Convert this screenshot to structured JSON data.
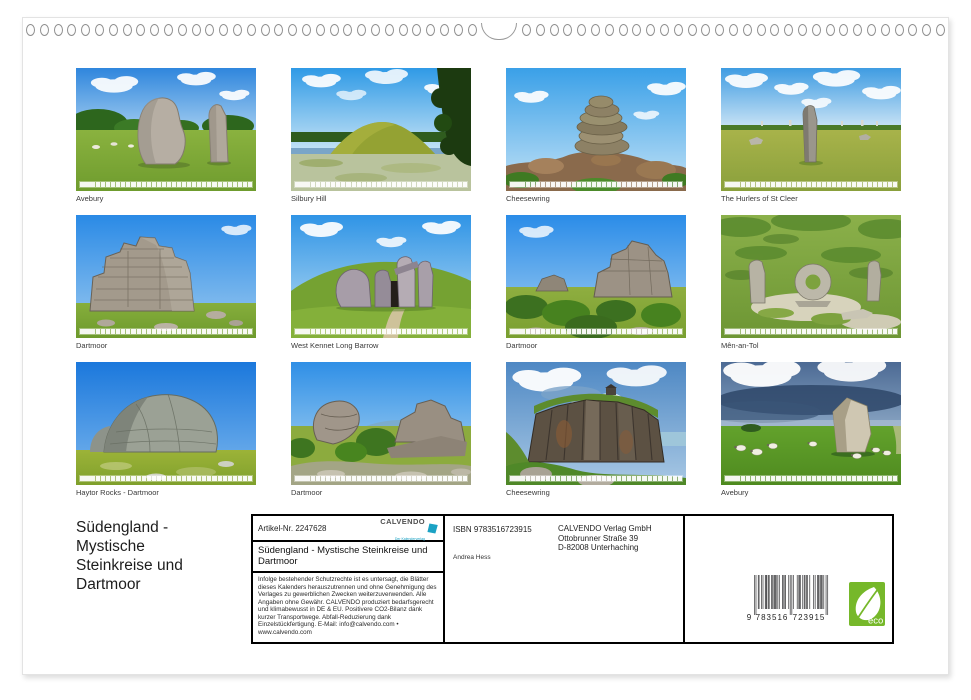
{
  "page": {
    "title_lines": [
      "Südengland -",
      "Mystische",
      "Steinkreise und",
      "Dartmoor"
    ]
  },
  "grid": {
    "items": [
      {
        "caption": "Avebury",
        "scene": "avebury_stones"
      },
      {
        "caption": "Silbury Hill",
        "scene": "silbury_hill"
      },
      {
        "caption": "Cheesewring",
        "scene": "cheesewring_stack"
      },
      {
        "caption": "The Hurlers of St Cleer",
        "scene": "hurlers_moor"
      },
      {
        "caption": "Dartmoor",
        "scene": "dartmoor_tor"
      },
      {
        "caption": "West Kennet Long Barrow",
        "scene": "west_kennet"
      },
      {
        "caption": "Dartmoor",
        "scene": "dartmoor_rock"
      },
      {
        "caption": "Mên-an-Tol",
        "scene": "men_an_tol"
      },
      {
        "caption": "Haytor Rocks - Dartmoor",
        "scene": "haytor_rocks"
      },
      {
        "caption": "Dartmoor",
        "scene": "dartmoor_boulders"
      },
      {
        "caption": "Cheesewring",
        "scene": "cheesewring_cliff"
      },
      {
        "caption": "Avebury",
        "scene": "avebury_sheep"
      }
    ]
  },
  "info_box": {
    "article_label": "Artikel-Nr. 2247628",
    "brand": {
      "name": "CALVENDO",
      "tagline": "Der Kalenderverlag"
    },
    "title": "Südengland - Mystische Steinkreise und Dartmoor",
    "legal": "Infolge bestehender Schutzrechte ist es untersagt, die Blätter dieses Kalenders herauszutrennen und ohne Genehmigung des Verlages zu gewerblichen Zwecken weiterzuverwenden. Alle Angaben ohne Gewähr. CALVENDO produziert bedarfsgerecht und klimabewusst in DE & EU. Positivere CO2-Bilanz dank kurzer Transportwege. Abfall-Reduzierung dank Einzelstückfertigung. E-Mail: info@calvendo.com • www.calvendo.com",
    "isbn": "ISBN 9783516723915",
    "author": "Andrea Hess",
    "publisher_lines": [
      "CALVENDO Verlag GmbH",
      "Ottobrunner Straße 39",
      "D-82008 Unterhaching"
    ],
    "barcode_digits": "9 783516 723915",
    "eco_label": "eco"
  },
  "colors": {
    "calvendo_teal": "#1ba2c4",
    "eco_green": "#76b82a",
    "barcode_gray": "#555557",
    "box_border": "#000000"
  }
}
